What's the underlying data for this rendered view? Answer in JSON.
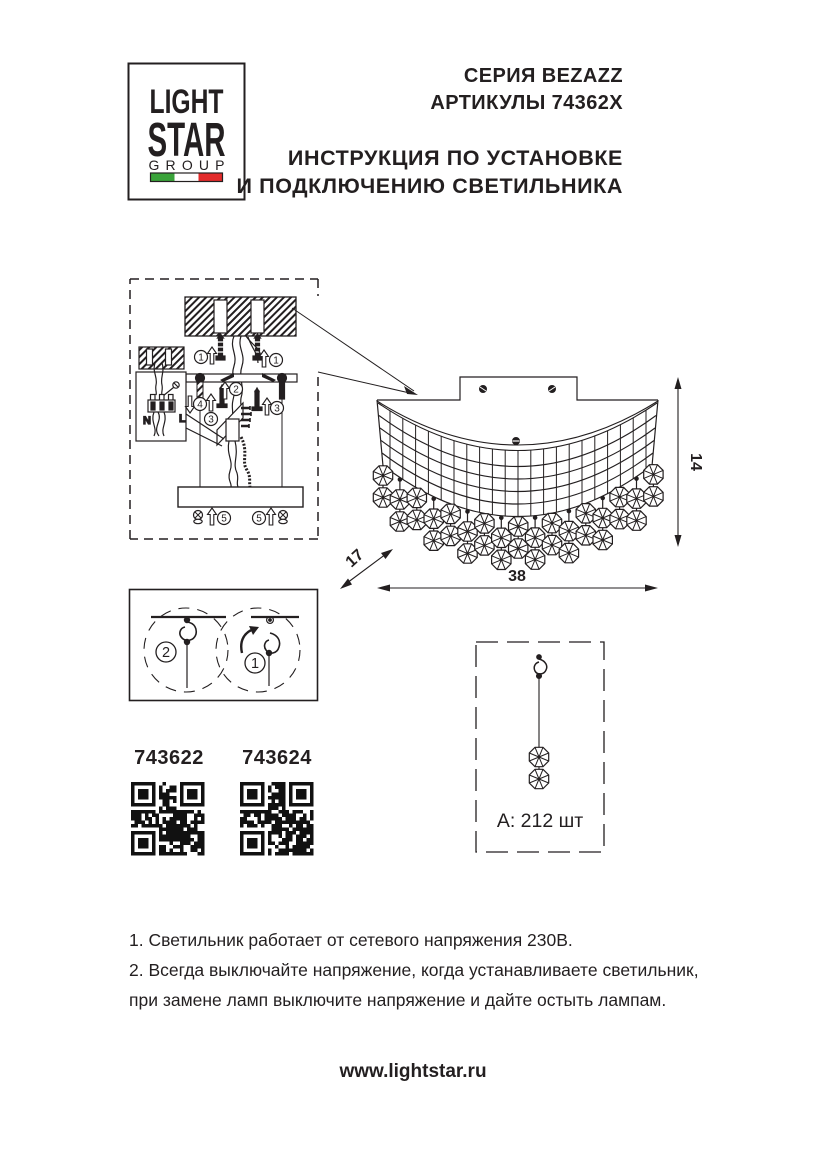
{
  "logo": {
    "word1": "LIGHT",
    "word2": "STAR",
    "word3": "GROUP"
  },
  "header": {
    "series": "СЕРИЯ BEZAZZ",
    "articles": "АРТИКУЛЫ 74362X",
    "title_line1": "ИНСТРУКЦИЯ ПО УСТАНОВКЕ",
    "title_line2": "И ПОДКЛЮЧЕНИЮ СВЕТИЛЬНИКА"
  },
  "install_steps": {
    "s1": "1",
    "s2": "2",
    "s3": "3",
    "s4": "4",
    "s5": "5"
  },
  "terminal": {
    "n": "N",
    "l": "L"
  },
  "dimensions": {
    "height": "14",
    "width": "38",
    "depth": "17"
  },
  "hook_steps": {
    "left": "2",
    "right": "1"
  },
  "pendant": {
    "count_label": "А: 212 шт"
  },
  "products": [
    {
      "article": "743622"
    },
    {
      "article": "743624"
    }
  ],
  "notes": {
    "line1": "1. Светильник работает от сетевого напряжения 230В.",
    "line2": "2. Всегда выключайте напряжение, когда устанавливаете светильник,",
    "line3": "при замене ламп выключите напряжение и дайте остыть лампам."
  },
  "footer": {
    "website": "www.lightstar.ru"
  },
  "colors": {
    "ink": "#231f20",
    "flag_green": "#3aa33a",
    "flag_white": "#ffffff",
    "flag_red": "#e32b2b"
  }
}
